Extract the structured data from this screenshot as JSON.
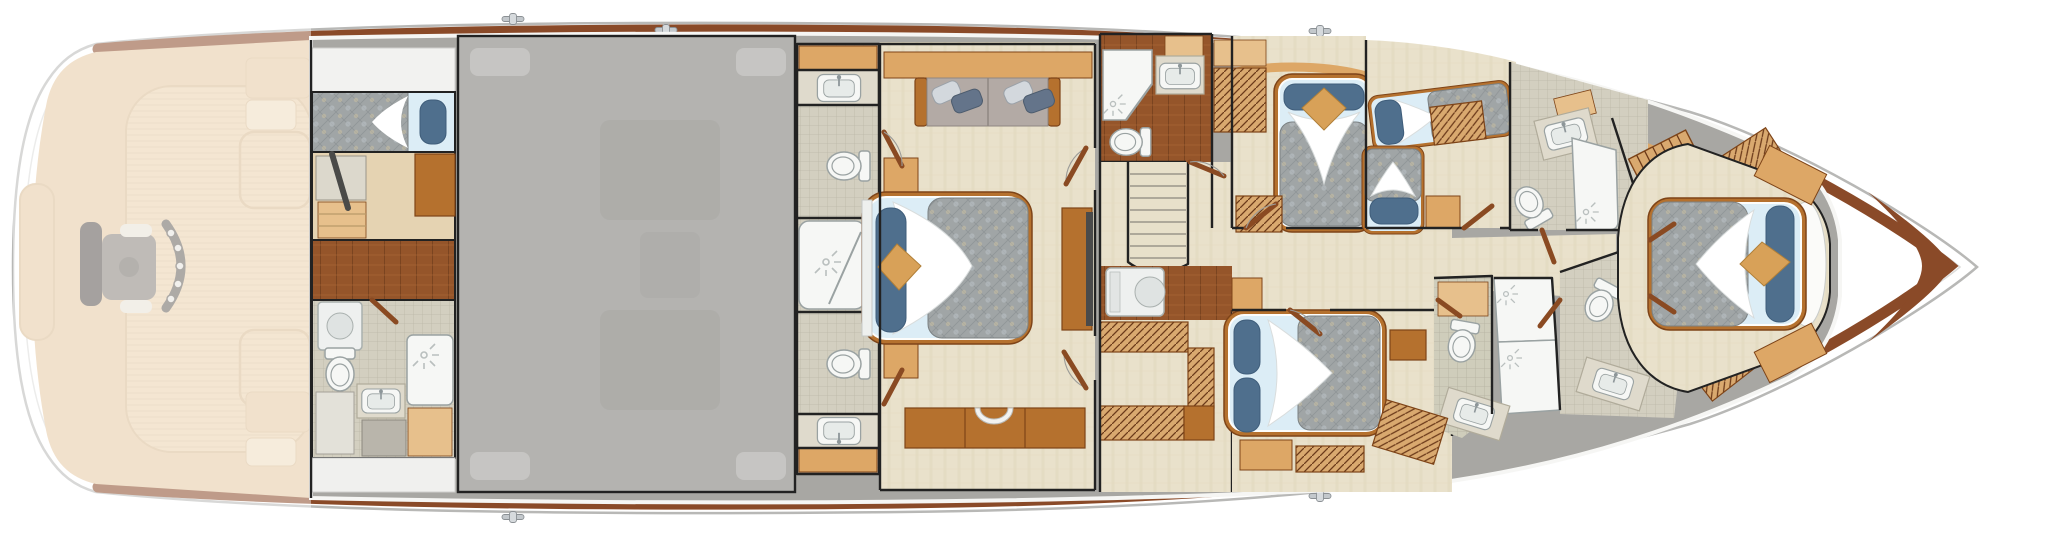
{
  "diagram": {
    "kind": "yacht-deck-plan",
    "view": "overhead accommodations-deck floor plan",
    "orientation": {
      "bow": "right",
      "stern": "left"
    }
  },
  "palette": {
    "hull-line": "#b8b8b6",
    "deck-white": "#ffffff",
    "rail-wood": "#8a4a28",
    "rail-wood-dark": "#6e3a1e",
    "ghost-wood": "#e6c8a2",
    "ghost-sole": "#ecd2ae",
    "ghost-line": "#d9bc94",
    "chair-dark": "#5b5550",
    "chair-mid": "#8a837c",
    "chair-pale": "#e8e2d6",
    "slab": "#a8a7a3",
    "engine": "#b4b3b0",
    "wall": "#222222",
    "carpet": "#e9e1cb",
    "carpet-line": "#ded4ba",
    "teak": "#95552a",
    "teak-line": "#6e3c1c",
    "teak-light": "#ad6b36",
    "maple": "#e5d3b2",
    "tile": "#d3cfc0",
    "tile-line": "#bcb8a8",
    "tile-green": "#cfcdbb",
    "granite": "#dfdacc",
    "granite-edge": "#b0ab9a",
    "fixture": "#f6f7f5",
    "fixture-line": "#9aa2a2",
    "furn-wood": "#b5712e",
    "furn-wood-dark": "#7e4418",
    "wood-light": "#dda766",
    "wood-pale": "#e7c08c",
    "hatch-base": "#d9a96f",
    "hatch-line": "#6b3a1a",
    "quilt": "#a0a5a6",
    "quilt-line": "#8c9194",
    "quilt-tan": "#c5bca4",
    "sheet": "#fdfdfb",
    "sheet-blue": "#dcedf6",
    "pillow-blue": "#4f6f8d",
    "pillow-tan": "#d8a158",
    "sofa": "#b3aaa5",
    "pillow-silver": "#d3d8dd",
    "pillow-slate": "#64748a",
    "washer": "#eef0ef",
    "stair": "#e8e0ca",
    "tread": "#9a958a",
    "swing": "#9b9b98",
    "door-wood": "#8a4a22"
  },
  "areas": [
    {
      "id": "hull",
      "label": "Hull outline with teak toe-rail and deck cleats",
      "fixtures": [
        "toe-rail",
        "cleats",
        "bow"
      ]
    },
    {
      "id": "cockpit",
      "label": "Aft cockpit (ghosted) with fighting chair, rod-holder arc, deck hatches and mezzanine",
      "fixtures": [
        "fighting-chair",
        "rod-holder-arc",
        "deck-hatch",
        "deck-hatch",
        "mezzanine-seating",
        "transom-door",
        "teak-sole"
      ]
    },
    {
      "id": "crew-quarters",
      "label": "Crew quarters with single berth, lockers and steps",
      "fixtures": [
        "berth",
        "hanging-locker",
        "drawers",
        "steps"
      ]
    },
    {
      "id": "crew-head",
      "label": "Crew head with shower, toilet, sink and washer",
      "fixtures": [
        "shower",
        "toilet",
        "sink",
        "washer-dryer",
        "cabinets"
      ]
    },
    {
      "id": "engine-room",
      "label": "Engine room (shown dimmed)",
      "fixtures": []
    },
    {
      "id": "master-head",
      "label": "Master head with twin sinks, twin toilets and central shower",
      "fixtures": [
        "sink",
        "sink",
        "toilet",
        "toilet",
        "shower",
        "cabinets"
      ]
    },
    {
      "id": "master-stateroom",
      "label": "Full-beam master stateroom",
      "fixtures": [
        "king-bed",
        "sofa",
        "nightstand",
        "nightstand",
        "dresser",
        "tv-cabinet",
        "vanity-stool"
      ]
    },
    {
      "id": "day-head",
      "label": "Day head with corner shower, toilet and sink",
      "fixtures": [
        "shower",
        "toilet",
        "sink"
      ]
    },
    {
      "id": "stair-foyer",
      "label": "Companionway stairs and foyer with washer and lockers",
      "fixtures": [
        "staircase",
        "washer-dryer",
        "drawer-chest",
        "hanging-locker"
      ]
    },
    {
      "id": "guest-stateroom-forward",
      "label": "Forward port guest stateroom with queen berth",
      "fixtures": [
        "queen-bed",
        "drawer-chest",
        "drawer-chest"
      ]
    },
    {
      "id": "twin-stateroom",
      "label": "Starboard guest stateroom with two single berths",
      "fixtures": [
        "single-berth",
        "single-berth",
        "nightstand",
        "drawer-chest"
      ]
    },
    {
      "id": "guest-stateroom-aft",
      "label": "Aft starboard guest stateroom with queen berth",
      "fixtures": [
        "queen-bed",
        "nightstand",
        "nightstand",
        "drawer-chest"
      ]
    },
    {
      "id": "forward-head-starboard",
      "label": "Starboard forward head with shower, toilet and sink",
      "fixtures": [
        "shower",
        "toilet",
        "sink"
      ]
    },
    {
      "id": "forward-head-port",
      "label": "Port forward heads with double shower, two toilets and two sinks",
      "fixtures": [
        "shower",
        "shower",
        "toilet",
        "toilet",
        "sink",
        "sink"
      ]
    },
    {
      "id": "forward-stairs",
      "label": "Forward companionway steps",
      "fixtures": [
        "staircase",
        "drawer-chest"
      ]
    },
    {
      "id": "vip-stateroom",
      "label": "Forward VIP stateroom with centerline queen berth",
      "fixtures": [
        "queen-bed",
        "nightstand",
        "nightstand",
        "drawer-chest"
      ]
    },
    {
      "id": "foredeck",
      "label": "Foredeck",
      "fixtures": []
    }
  ]
}
